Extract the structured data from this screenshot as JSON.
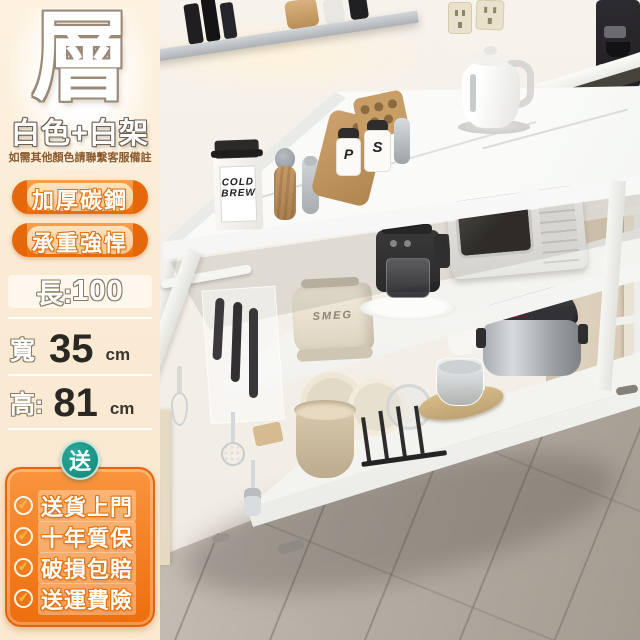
{
  "panel": {
    "headline_char": "層",
    "subtitle": "白色+白架",
    "note": "如需其他顏色請聯繫客服備註",
    "badges": [
      {
        "label": "加厚碳鋼"
      },
      {
        "label": "承重強悍"
      }
    ],
    "dimensions": {
      "length_label": "長:",
      "length_value": "100",
      "width_label": "寬",
      "width_value": "35",
      "width_unit": "cm",
      "height_label": "高:",
      "height_value": "81",
      "height_unit": "cm"
    },
    "gift": {
      "badge_label": "送",
      "check_icon": "✔",
      "items": [
        {
          "text": "送貨上門"
        },
        {
          "text": "十年質保"
        },
        {
          "text": "破損包賠"
        },
        {
          "text": "送運費險"
        }
      ]
    },
    "colors": {
      "panel_bg": "#fbeeda",
      "badge_orange": "#ec6c08",
      "gift_panel_orange": "#f2791c",
      "gift_badge_teal": "#1a9a8b",
      "number_dark": "#2b2722"
    }
  },
  "photo": {
    "toaster_brand": "SMEG",
    "spice_jar_left": "P",
    "spice_jar_right": "S",
    "coffee_bag_line1": "COLD",
    "coffee_bag_line2": "BREW"
  }
}
